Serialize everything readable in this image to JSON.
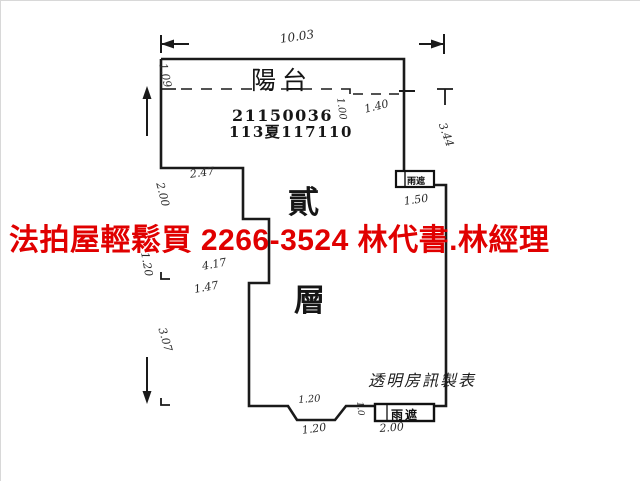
{
  "plan": {
    "balcony_label": "陽台",
    "case_number_line1": "21150036",
    "case_number_line2": "113夏117110",
    "floor_char_top": "貳",
    "floor_char_bottom": "層",
    "canopy_top_label": "雨遮",
    "canopy_bottom_label": "雨遮",
    "credit_label": "透明房訊製表"
  },
  "overlay": {
    "ad_text": "法拍屋輕鬆買  2266-3524  林代書.林經理",
    "color": "#e00000"
  },
  "annotations": [
    {
      "text": "10.03"
    },
    {
      "text": "1.09"
    },
    {
      "text": "1.00"
    },
    {
      "text": "1.40"
    },
    {
      "text": "2.47"
    },
    {
      "text": "2.00"
    },
    {
      "text": "1.20"
    },
    {
      "text": "4.17"
    },
    {
      "text": "1.47"
    },
    {
      "text": "3.07"
    },
    {
      "text": "3.44"
    },
    {
      "text": "1.50"
    },
    {
      "text": "1.20"
    },
    {
      "text": "1.20"
    },
    {
      "text": "2.00"
    },
    {
      "text": "1.0"
    }
  ],
  "colors": {
    "line": "#1a1a1a",
    "ad_red": "#e00000",
    "background": "#ffffff"
  }
}
